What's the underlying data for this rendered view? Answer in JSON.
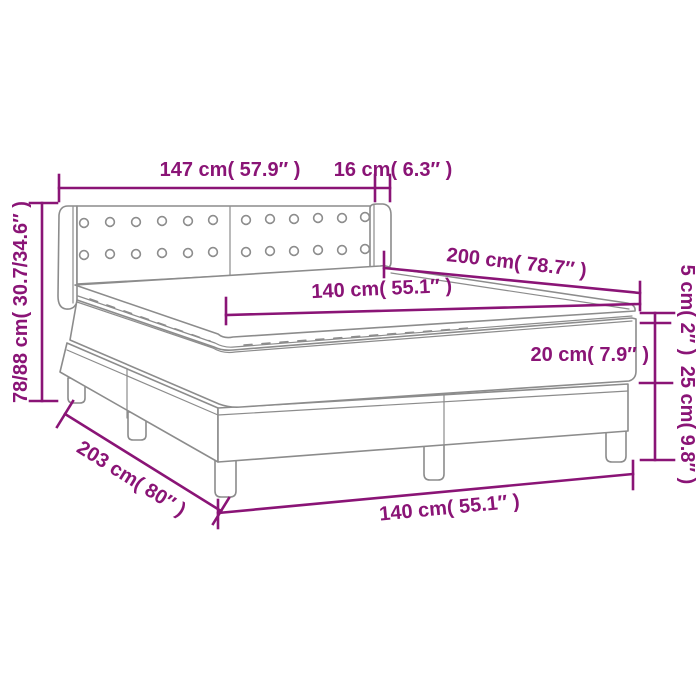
{
  "diagram": {
    "product": "Box spring bed with headboard, mattress topper and legs",
    "view": "perspective dimension line drawing",
    "accent_color": "#8A1476",
    "outline_color": "#8C8C8C",
    "background_color": "#FFFFFF",
    "measurements": {
      "headboard_width": "147 cm( 57.9″ )",
      "headboard_wing_depth": "16 cm( 6.3″ )",
      "headboard_height_range": "78/88 cm( 30.7/34.6″ )",
      "bed_length": "200 cm( 78.7″ )",
      "mattress_top_width": "140 cm( 55.1″ )",
      "topper_thickness": "5 cm( 2″ )",
      "mattress_thickness": "20 cm( 7.9″ )",
      "base_height": "25 cm( 9.8″ )",
      "base_length": "203 cm( 80″ )",
      "base_width": "140 cm( 55.1″ )"
    }
  }
}
